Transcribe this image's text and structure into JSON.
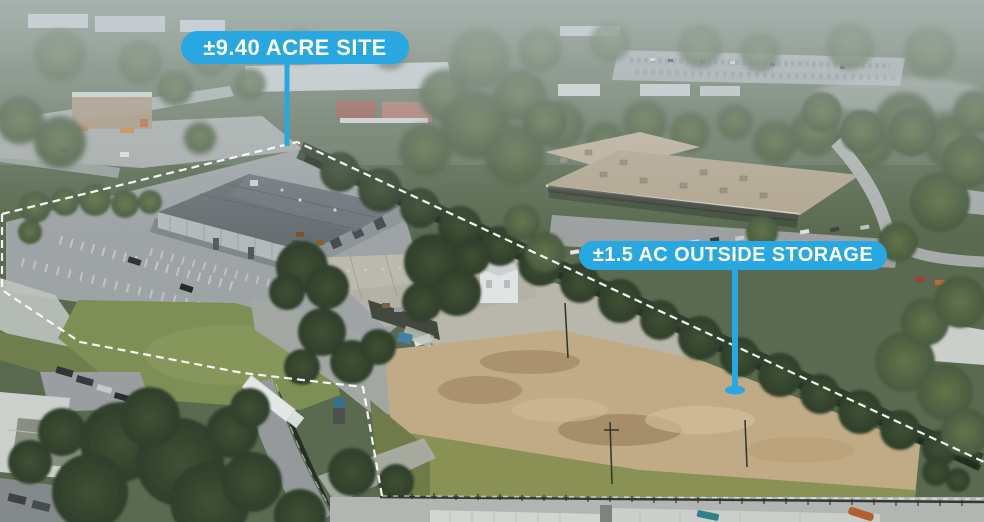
{
  "scene": {
    "type": "aerial-drone-photo",
    "description": "Aerial photo of a ±9.40 acre industrial site outlined in white dashes: a large gray-roof warehouse with parking lots and lawn, a second metal workshop building with white cupola, and a fenced ±1.5 acre dirt outside-storage yard, surrounded by trees, roads, trucks and neighboring commercial buildings",
    "annotation_accent_color": "#29a7e0",
    "boundary_color": "#ffffff",
    "label_text_color": "#ffffff"
  },
  "callouts": {
    "site_area": {
      "text": "±9.40 ACRE SITE"
    },
    "outside_storage": {
      "text": "±1.5 AC OUTSIDE STORAGE"
    }
  }
}
